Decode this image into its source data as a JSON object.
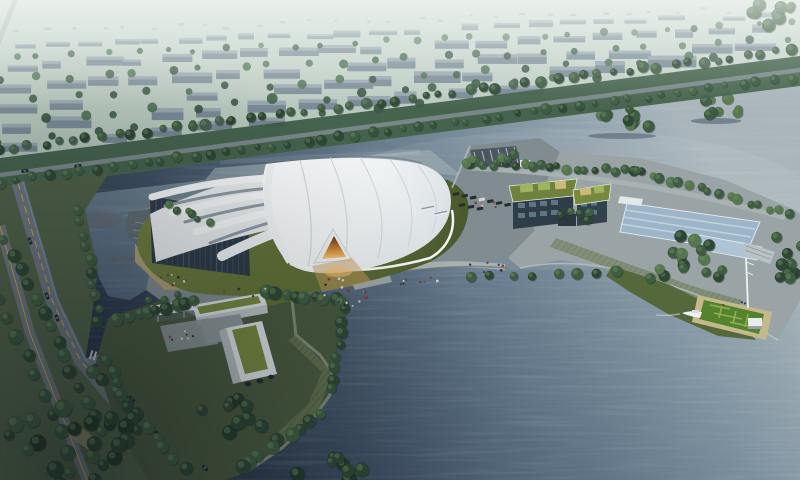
{
  "meta": {
    "title": "Aerial architectural rendering - lakeside exhibition center",
    "type": "architectural-rendering",
    "width": 800,
    "height": 480,
    "description": "Bird's-eye render of a white shell-roofed exhibition hall beside a large lake: ribbed white dome with amber entrance portal, sandy terrace, tree-lined roads, L-shaped green-roofed office block, waterfront peninsula with two green-roof buildings and a reflecting pool, dock with boat and mast, hazy city blocks in the distance."
  },
  "palette": {
    "hazeTop": "#dfe7e2",
    "fieldGreen": "#a3b6ab",
    "cityFar": "#9aa8ac",
    "treeDark": "#2e4735",
    "treeMid": "#3e5c42",
    "treeLight": "#547750",
    "treeBlue": "#46604f",
    "waterLight": "#a9b5bb",
    "waterMid": "#5d7184",
    "waterDeep": "#3c4d60",
    "waterDark": "#222c3a",
    "lakeSmallTop": "#8a9aa3",
    "lakeSmallBottom": "#51647a",
    "lawn": "#6d7c3e",
    "lawnShadow": "#49592e",
    "plaza": "#808c90",
    "promenade": "#9aa4a6",
    "sand": "#ac9d72",
    "roadGrey": "#6a747c",
    "roadLine": "#c9a43e",
    "roofWhite": "#f4f6f6",
    "roofShade": "#d6dcdf",
    "roofSeam": "#ccd3d8",
    "ribShadow": "#8e9aa4",
    "glassDark": "#2d3b47",
    "glassLight": "#48596a",
    "facadeDark": "#2f3d48",
    "windowLight": "#5d7584",
    "greenRoof": "#74873f",
    "greenRoofLight": "#9fb45e",
    "roofPanelTan": "#c9b97b",
    "poolBlue": "#aec4d5",
    "amber": "#c87f35",
    "amberGlow": "#f0bc6d",
    "busWhite": "#e6eaea",
    "carDark": "#1f262e",
    "dockDeck": "#c3b98b",
    "dockGreen": "#55822f",
    "dockGreenLight": "#8db14e"
  },
  "procedural": {
    "far_dots": {
      "x1": 20,
      "y1": 30,
      "x2": 780,
      "y2": 8,
      "count": 30,
      "color": "#b7c3c4"
    },
    "city_rows": [
      {
        "x1": 15,
        "y1": 50,
        "x2": 785,
        "y2": 16,
        "count": 24,
        "minW": 14,
        "maxW": 30,
        "minH": 4,
        "maxH": 7,
        "facade": "#9aa9ae",
        "top": "#b3bfc2"
      },
      {
        "x1": 5,
        "y1": 70,
        "x2": 790,
        "y2": 32,
        "count": 20,
        "minW": 18,
        "maxW": 40,
        "minH": 6,
        "maxH": 9,
        "facade": "#8e9ca6",
        "top": "#a9b5bb"
      },
      {
        "x1": 0,
        "y1": 92,
        "x2": 780,
        "y2": 48,
        "count": 18,
        "minW": 20,
        "maxW": 46,
        "minH": 7,
        "maxH": 11,
        "facade": "#8595a0",
        "top": "#a3afb7"
      },
      {
        "x1": 0,
        "y1": 112,
        "x2": 690,
        "y2": 66,
        "count": 15,
        "minW": 22,
        "maxW": 50,
        "minH": 8,
        "maxH": 12,
        "facade": "#7e8e99",
        "top": "#9daab3"
      },
      {
        "x1": 0,
        "y1": 132,
        "x2": 545,
        "y2": 92,
        "count": 11,
        "minW": 22,
        "maxW": 48,
        "minH": 8,
        "maxH": 13,
        "facade": "#798996",
        "top": "#97a5af"
      },
      {
        "x1": 0,
        "y1": 152,
        "x2": 300,
        "y2": 122,
        "count": 6,
        "minW": 20,
        "maxW": 40,
        "minH": 7,
        "maxH": 10,
        "facade": "#75858f",
        "top": "#909ea6"
      }
    ],
    "city_tree_rows": [
      {
        "x1": 10,
        "y1": 58,
        "x2": 788,
        "y2": 24,
        "count": 26,
        "rmin": 2.5,
        "rmax": 4,
        "colors": [
          "#587862",
          "#4a6a54",
          "#668a6d"
        ]
      },
      {
        "x1": 0,
        "y1": 80,
        "x2": 786,
        "y2": 40,
        "count": 24,
        "rmin": 3,
        "rmax": 4.5,
        "colors": [
          "#4f7058",
          "#456350",
          "#5d8063"
        ]
      },
      {
        "x1": 0,
        "y1": 102,
        "x2": 720,
        "y2": 56,
        "count": 20,
        "rmin": 3,
        "rmax": 5,
        "colors": [
          "#46624e",
          "#3e5a48",
          "#527459"
        ]
      },
      {
        "x1": 0,
        "y1": 122,
        "x2": 600,
        "y2": 76,
        "count": 16,
        "rmin": 3.5,
        "rmax": 5.5,
        "colors": [
          "#3f5c47",
          "#375440",
          "#4c6e52"
        ]
      },
      {
        "x1": 0,
        "y1": 142,
        "x2": 420,
        "y2": 104,
        "count": 10,
        "rmin": 3.5,
        "rmax": 5.5,
        "colors": [
          "#3a5742",
          "#32503c"
        ]
      }
    ],
    "tree_rows": [
      {
        "x1": 0,
        "y1": 150,
        "x2": 790,
        "y2": 50,
        "count": 55,
        "rmin": 3.5,
        "rmax": 6,
        "colors": [
          "#2e4735",
          "#3e5c42",
          "#46604f"
        ]
      },
      {
        "x1": 0,
        "y1": 182,
        "x2": 790,
        "y2": 78,
        "count": 50,
        "rmin": 3,
        "rmax": 5.5,
        "colors": [
          "#2e4735",
          "#3e5c42",
          "#35523e"
        ]
      },
      {
        "x1": 6,
        "y1": 240,
        "x2": 100,
        "y2": 430,
        "count": 14,
        "rmin": 4.5,
        "rmax": 7,
        "colors": [
          "#3e5c42",
          "#2e4735"
        ]
      },
      {
        "x1": 0,
        "y1": 300,
        "x2": 70,
        "y2": 452,
        "count": 9,
        "rmin": 5,
        "rmax": 8,
        "colors": [
          "#2e4735",
          "#3a5740"
        ]
      },
      {
        "x1": 80,
        "y1": 210,
        "x2": 100,
        "y2": 320,
        "count": 10,
        "rmin": 4,
        "rmax": 6,
        "colors": [
          "#3e5c42",
          "#2e4735"
        ]
      },
      {
        "x1": 95,
        "y1": 370,
        "x2": 185,
        "y2": 470,
        "count": 10,
        "rmin": 5,
        "rmax": 7,
        "colors": [
          "#2e4735",
          "#3e5c42"
        ]
      },
      {
        "x1": 170,
        "y1": 206,
        "x2": 208,
        "y2": 221,
        "count": 6,
        "rmin": 3,
        "rmax": 4.5,
        "colors": [
          "#3e5c42",
          "#547750"
        ]
      },
      {
        "x1": 468,
        "y1": 162,
        "x2": 640,
        "y2": 172,
        "count": 20,
        "rmin": 3.5,
        "rmax": 5.5,
        "colors": [
          "#3e5c42",
          "#547750",
          "#2e4735"
        ]
      },
      {
        "x1": 640,
        "y1": 172,
        "x2": 788,
        "y2": 214,
        "count": 16,
        "rmin": 3.5,
        "rmax": 5.5,
        "colors": [
          "#3e5c42",
          "#547750"
        ]
      },
      {
        "x1": 470,
        "y1": 278,
        "x2": 620,
        "y2": 272,
        "count": 8,
        "rmin": 4,
        "rmax": 6,
        "colors": [
          "#3e5c42",
          "#2e4735"
        ]
      },
      {
        "x1": 118,
        "y1": 318,
        "x2": 195,
        "y2": 300,
        "count": 9,
        "rmin": 5,
        "rmax": 7,
        "colors": [
          "#2e4735",
          "#3e5c42"
        ]
      },
      {
        "x1": 265,
        "y1": 292,
        "x2": 345,
        "y2": 302,
        "count": 9,
        "rmin": 5,
        "rmax": 7,
        "colors": [
          "#2e4735",
          "#3e5c42"
        ]
      },
      {
        "x1": 345,
        "y1": 310,
        "x2": 330,
        "y2": 390,
        "count": 8,
        "rmin": 4.5,
        "rmax": 6.5,
        "colors": [
          "#2e4735",
          "#35523e"
        ]
      },
      {
        "x1": 320,
        "y1": 415,
        "x2": 240,
        "y2": 468,
        "count": 9,
        "rmin": 5,
        "rmax": 8,
        "colors": [
          "#2e4735",
          "#3e5c42"
        ]
      },
      {
        "x1": 105,
        "y1": 360,
        "x2": 140,
        "y2": 430,
        "count": 7,
        "rmin": 5,
        "rmax": 7,
        "colors": [
          "#2e4735",
          "#3a5740"
        ]
      },
      {
        "x1": 150,
        "y1": 300,
        "x2": 175,
        "y2": 296,
        "count": 3,
        "rmin": 3,
        "rmax": 4,
        "colors": [
          "#3e5c42"
        ]
      }
    ],
    "tree_clusters": [
      {
        "cx": 622,
        "cy": 120,
        "rx": 38,
        "ry": 12,
        "count": 11,
        "rmin": 3.5,
        "rmax": 6,
        "reflect": true,
        "colors": [
          "#3e5c42",
          "#547750",
          "#2e4735"
        ]
      },
      {
        "cx": 716,
        "cy": 107,
        "rx": 28,
        "ry": 10,
        "count": 8,
        "rmin": 3.5,
        "rmax": 6,
        "reflect": true,
        "colors": [
          "#3e5c42",
          "#547750"
        ]
      },
      {
        "cx": 772,
        "cy": 16,
        "rx": 30,
        "ry": 14,
        "count": 9,
        "rmin": 4,
        "rmax": 7,
        "reflect": false,
        "colors": [
          "#46604f",
          "#3e5c42"
        ]
      },
      {
        "cx": 60,
        "cy": 445,
        "rx": 85,
        "ry": 42,
        "count": 26,
        "rmin": 5,
        "rmax": 9,
        "reflect": false,
        "colors": [
          "#2e4735",
          "#243c2c",
          "#3e5c42"
        ]
      },
      {
        "cx": 492,
        "cy": 160,
        "rx": 28,
        "ry": 10,
        "count": 6,
        "rmin": 3.5,
        "rmax": 5,
        "reflect": false,
        "colors": [
          "#3e5c42",
          "#547750"
        ]
      },
      {
        "cx": 575,
        "cy": 215,
        "rx": 18,
        "ry": 8,
        "count": 5,
        "rmin": 3.5,
        "rmax": 5,
        "reflect": false,
        "colors": [
          "#3e5c42",
          "#2e4735"
        ]
      },
      {
        "cx": 685,
        "cy": 262,
        "rx": 48,
        "ry": 26,
        "count": 16,
        "rmin": 4.5,
        "rmax": 7,
        "reflect": false,
        "colors": [
          "#2e4735",
          "#3e5c42",
          "#547750"
        ]
      },
      {
        "cx": 786,
        "cy": 250,
        "rx": 16,
        "ry": 36,
        "count": 9,
        "rmin": 4.5,
        "rmax": 7,
        "reflect": false,
        "colors": [
          "#2e4735",
          "#3e5c42"
        ]
      },
      {
        "cx": 230,
        "cy": 420,
        "rx": 40,
        "ry": 22,
        "count": 10,
        "rmin": 5,
        "rmax": 8,
        "reflect": false,
        "colors": [
          "#2e4735",
          "#243c2c"
        ]
      },
      {
        "cx": 335,
        "cy": 470,
        "rx": 45,
        "ry": 14,
        "count": 8,
        "rmin": 5,
        "rmax": 8,
        "reflect": false,
        "colors": [
          "#223a2a",
          "#2e4735"
        ]
      }
    ],
    "people": {
      "colors": [
        "#93352b",
        "#32323a",
        "#d8d2c6",
        "#64463c"
      ],
      "clusters": [
        {
          "cx": 345,
          "cy": 300,
          "rx": 28,
          "ry": 12,
          "count": 14
        },
        {
          "cx": 415,
          "cy": 280,
          "rx": 30,
          "ry": 8,
          "count": 8
        },
        {
          "cx": 480,
          "cy": 268,
          "rx": 25,
          "ry": 6,
          "count": 6
        },
        {
          "cx": 172,
          "cy": 280,
          "rx": 16,
          "ry": 8,
          "count": 8
        },
        {
          "cx": 180,
          "cy": 337,
          "rx": 14,
          "ry": 7,
          "count": 7
        },
        {
          "cx": 495,
          "cy": 203,
          "rx": 20,
          "ry": 6,
          "count": 4
        },
        {
          "cx": 735,
          "cy": 305,
          "rx": 12,
          "ry": 5,
          "count": 3
        },
        {
          "cx": 250,
          "cy": 292,
          "rx": 35,
          "ry": 5,
          "count": 6
        },
        {
          "cx": 338,
          "cy": 283,
          "rx": 14,
          "ry": 6,
          "count": 6
        }
      ]
    },
    "vehicles": {
      "cars": [
        {
          "x": 25,
          "y": 171,
          "a": -8
        },
        {
          "x": 78,
          "y": 166,
          "a": -8
        },
        {
          "x": 30,
          "y": 241,
          "a": 70
        },
        {
          "x": 47,
          "y": 296,
          "a": 70
        },
        {
          "x": 57,
          "y": 318,
          "a": 70
        },
        {
          "x": 132,
          "y": 399,
          "a": 48
        },
        {
          "x": 158,
          "y": 434,
          "a": 48
        },
        {
          "x": 182,
          "y": 339,
          "a": -6
        },
        {
          "x": 205,
          "y": 468,
          "a": 48
        }
      ],
      "parking_rows": [
        {
          "x0": 456,
          "y0": 194,
          "dx": 8.6,
          "dy": 1.8,
          "count": 7,
          "angle": -10
        },
        {
          "x0": 462,
          "y0": 205,
          "dx": 9.0,
          "dy": 1.8,
          "count": 3,
          "angle": -10
        }
      ],
      "buses": [
        {
          "x": 428,
          "y": 208,
          "a": -12
        },
        {
          "x": 441,
          "y": 213,
          "a": -12
        }
      ]
    }
  }
}
